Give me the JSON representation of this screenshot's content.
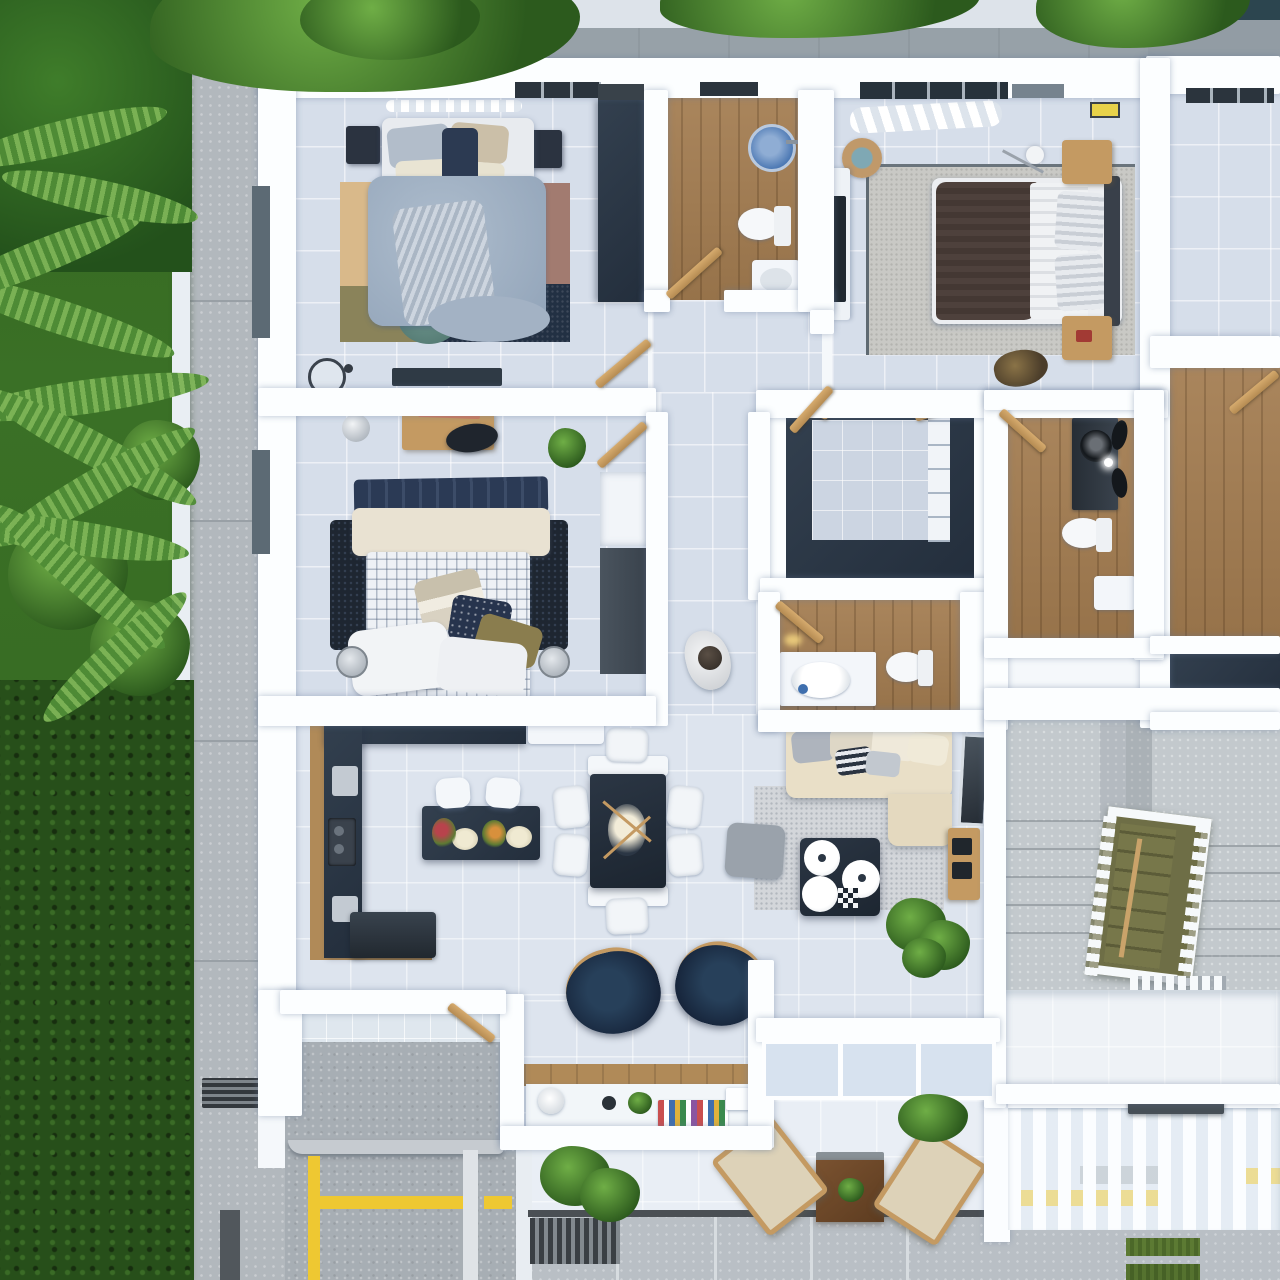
{
  "scene": {
    "type": "3d-floor-plan-aerial-render",
    "description": "Photorealistic top-down 3D render of an apartment floor plan with garden, concrete walkway, parking stall, stairwell and street-side terrace",
    "units": 2,
    "rooms": [
      {
        "id": "bedroom-top-left",
        "label": "Bedroom 1",
        "floor": "light-tile",
        "furniture": [
          "double-bed-gray-bedding",
          "pillows",
          "nightstand-left",
          "nightstand-right",
          "dark-wardrobe",
          "patchwork-rug-tan-mauve-navy-olive",
          "round-teal-rug",
          "tv-console",
          "round-mirror",
          "window-curtain"
        ]
      },
      {
        "id": "bathroom-top",
        "label": "Bathroom 1",
        "floor": "wood-plank",
        "furniture": [
          "round-blue-sink",
          "toilet",
          "white-vanity",
          "swing-door"
        ]
      },
      {
        "id": "bedroom-top-right",
        "label": "Bedroom 2",
        "floor": "light-tile",
        "furniture": [
          "double-bed-brown-blanket",
          "striped-pillows",
          "wood-nightstand-top",
          "wood-nightstand-bottom",
          "desk-with-monitor",
          "floor-lamp",
          "curtains",
          "basket",
          "gray-area-rug",
          "floor-bag"
        ]
      },
      {
        "id": "bedroom-middle-left",
        "label": "Bedroom 3",
        "floor": "light-tile",
        "furniture": [
          "double-bed-checked-duvet",
          "navy-throw",
          "pillow-pile",
          "dark-shag-rug",
          "desk",
          "desk-chair",
          "decor-sphere",
          "potted-plant",
          "wardrobe-niche",
          "floor-lamp-left",
          "floor-lamp-right",
          "swing-door"
        ]
      },
      {
        "id": "walk-in-closet",
        "label": "Walk-in Closet",
        "floor": "light-tile",
        "furniture": [
          "u-shaped-dark-wardrobe",
          "white-shelf-column",
          "wood-rails"
        ]
      },
      {
        "id": "bathroom-middle",
        "label": "Bathroom 2",
        "floor": "wood-plank",
        "furniture": [
          "counter-with-oval-sink",
          "toilet",
          "swing-door",
          "wall-lamp"
        ]
      },
      {
        "id": "bathroom-right",
        "label": "Bathroom 3",
        "floor": "wood-plank",
        "furniture": [
          "dark-vanity-round-vessel-sink",
          "toilet",
          "white-cabinet",
          "swing-door"
        ]
      },
      {
        "id": "hallway",
        "label": "Hallway",
        "floor": "light-tile",
        "furniture": [
          "person-standing"
        ]
      },
      {
        "id": "kitchen",
        "label": "Kitchen",
        "floor": "light-tile",
        "furniture": [
          "l-shaped-navy-counter",
          "wood-edge-band",
          "sink",
          "cooktop",
          "fridge",
          "island-with-food",
          "bar-stool-1",
          "bar-stool-2",
          "upper-cabinet"
        ]
      },
      {
        "id": "dining",
        "label": "Dining Area",
        "floor": "light-tile",
        "furniture": [
          "dark-dining-table",
          "flower-centerpiece",
          "white-chair-x6",
          "white-bench-caps"
        ]
      },
      {
        "id": "living",
        "label": "Living Room",
        "floor": "light-tile",
        "furniture": [
          "l-shaped-beige-sofa",
          "cushions",
          "speckled-gray-rug",
          "gray-pouf",
          "navy-coffee-table-with-round-trays",
          "checkerboard",
          "media-console-with-speakers",
          "leaning-mirror",
          "potted-plant"
        ]
      },
      {
        "id": "study-nook",
        "label": "Study Nook",
        "floor": "light-tile",
        "furniture": [
          "navy-armchair-left",
          "navy-armchair-right",
          "wood-desk",
          "desk-lamp",
          "cup",
          "small-plant",
          "book-row",
          "white-box"
        ]
      },
      {
        "id": "laundry",
        "label": "Laundry / Service",
        "floor": "concrete",
        "furniture": [
          "washing-machine",
          "white-appliance",
          "utility-sink-box",
          "swing-door"
        ]
      },
      {
        "id": "terrace",
        "label": "Terrace",
        "floor": "white-tile",
        "furniture": [
          "square-wood-table",
          "planter-centerpiece",
          "lounge-chair-left",
          "lounge-chair-right",
          "potted-plant",
          "floor-grate"
        ]
      },
      {
        "id": "stairwell",
        "label": "Stairwell",
        "floor": "concrete",
        "furniture": [
          "white-railing-frame",
          "olive-stair-flight",
          "concrete-steps",
          "landing"
        ]
      },
      {
        "id": "neighbor-unit",
        "label": "Adjacent Unit (partial)",
        "rooms": [
          "empty-tile-bedroom",
          "wood-floor-room",
          "dark-wardrobe-strip"
        ]
      }
    ],
    "exterior": {
      "garden": "palm-fronds-and-dense-hedges",
      "walkway": "concrete-with-joints-and-grate",
      "parking": {
        "surface": "concrete",
        "stall_lines": "yellow",
        "divider_line": "white"
      },
      "fence": "white-vertical-louvers",
      "mailbox": "dark-gray-box-on-fence",
      "sidewalk": "concrete-panels-with-grass-joint-strips",
      "overhanging_trees": 3
    }
  },
  "palette": {
    "wall": "#fcfeff",
    "tile": "#d6deea",
    "tile2": "#dde4ee",
    "wood": "#a37c50",
    "navy": "#232e3c",
    "navyl": "#33404f",
    "concrete": "#aeb5bb",
    "concdark": "#979ea5",
    "conctop": "#929ca4",
    "sofa": "#e9dfc7",
    "ruggray": "#ccd0d5",
    "woodacc": "#c49a62",
    "yellow": "#eec832",
    "olive": "#6e6e46",
    "glass": "#d7e2ef",
    "whitef": "#f3f6fa",
    "garden": "#3a7026",
    "leafl": "#6fae46",
    "leafd": "#2c5a1d",
    "grass": "#5c7a33",
    "grate": "#3c4247",
    "mailbox": "#474f56",
    "hedge": "#274f1a",
    "rug_tan": "#d9b98a",
    "rug_mauve": "#a27b70",
    "rug_olive": "#8a835a",
    "rug_navy": "#223043",
    "teal": "#5e8780",
    "bed_gray": "#9fb0c3",
    "blanket_brown": "#4e413c",
    "duvet_check": "#eef1f5"
  }
}
